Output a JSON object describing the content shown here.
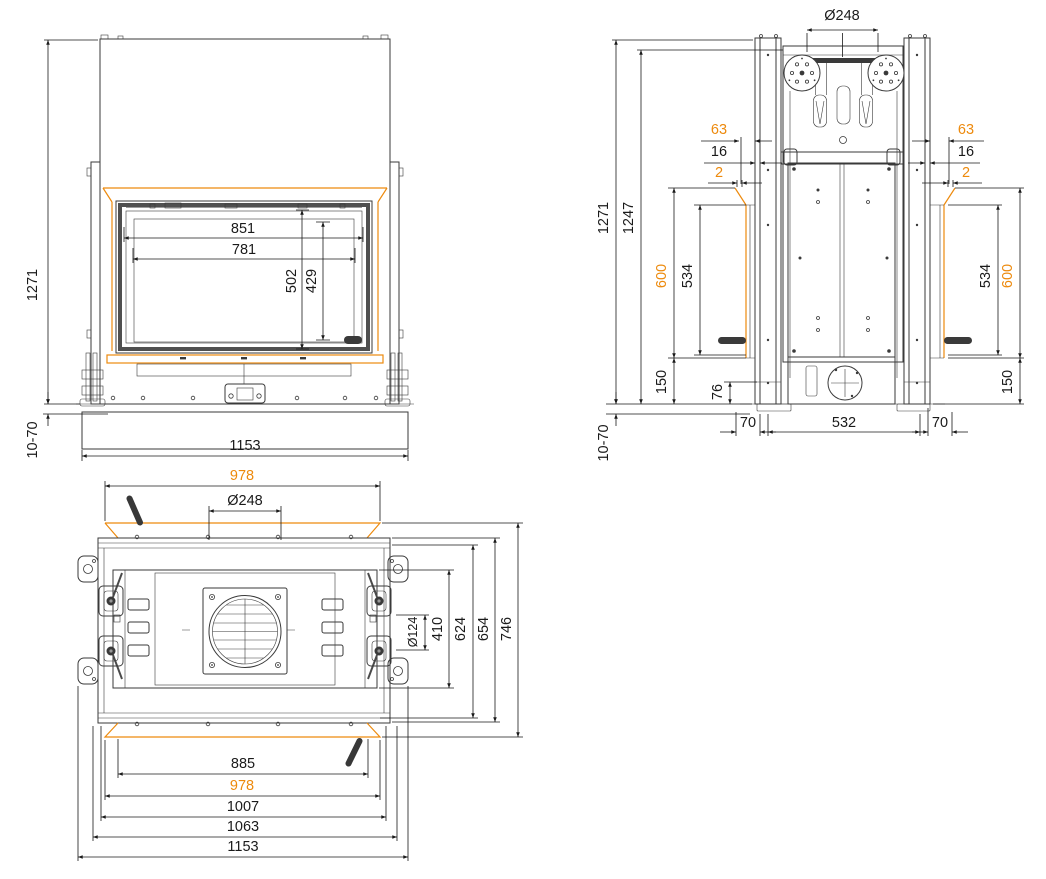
{
  "drawing": {
    "title": "fireplace-insert-three-view-dimension-drawing",
    "colors": {
      "line": "#3a3a3a",
      "dimension": "#1a1a1a",
      "accent_orange": "#ED8A0D",
      "dark_fill": "#383838",
      "background": "#ffffff"
    },
    "views": {
      "front": {
        "dims": {
          "frame_width": "851",
          "glass_width": "781",
          "frame_height": "502",
          "glass_height": "429",
          "overall_height": "1271",
          "floor_adjust": "10-70",
          "overall_width": "1153"
        }
      },
      "rear": {
        "dims": {
          "flue_diameter": "Ø248",
          "glass_offset": "63",
          "frame_offset": "16",
          "gap": "2",
          "overall_height": "1271",
          "body_height": "1247",
          "side_glass_height": "600",
          "side_panel_height": "534",
          "base_height": "150",
          "base_step": "76",
          "base_side_offset": "70",
          "base_width": "532",
          "floor_adjust": "10-70"
        }
      },
      "top": {
        "dims": {
          "glass_width_front": "978",
          "flue_diameter": "Ø248",
          "fan_diameter": "Ø124",
          "inner_depth": "410",
          "mid_depth": "624",
          "outer_depth": "654",
          "overall_depth": "746",
          "width_885": "885",
          "glass_width_rear": "978",
          "width_1007": "1007",
          "width_1063": "1063",
          "overall_width": "1153"
        }
      }
    }
  }
}
